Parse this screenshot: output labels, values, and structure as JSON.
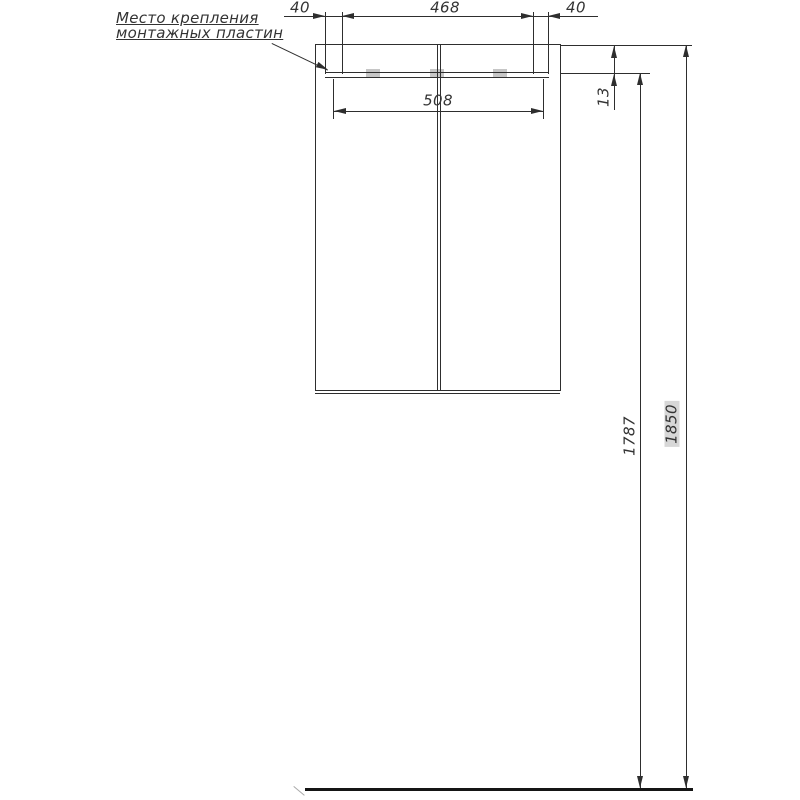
{
  "drawing": {
    "type": "technical-elevation-drawing",
    "note": {
      "line1": "Место крепления",
      "line2": "монтажных пластин"
    },
    "dims": {
      "top_left": "40",
      "top_span": "468",
      "top_right": "40",
      "body_width": "508",
      "rail_offset": "13",
      "mount_height": "1787",
      "overall_height": "1850"
    },
    "colors": {
      "line": "#2e2e2e",
      "text": "#333333",
      "mounting_plate": "#c6c6c6",
      "floor_line": "#151515",
      "label_backdrop": "#d7d7d7",
      "background": "#ffffff"
    }
  }
}
